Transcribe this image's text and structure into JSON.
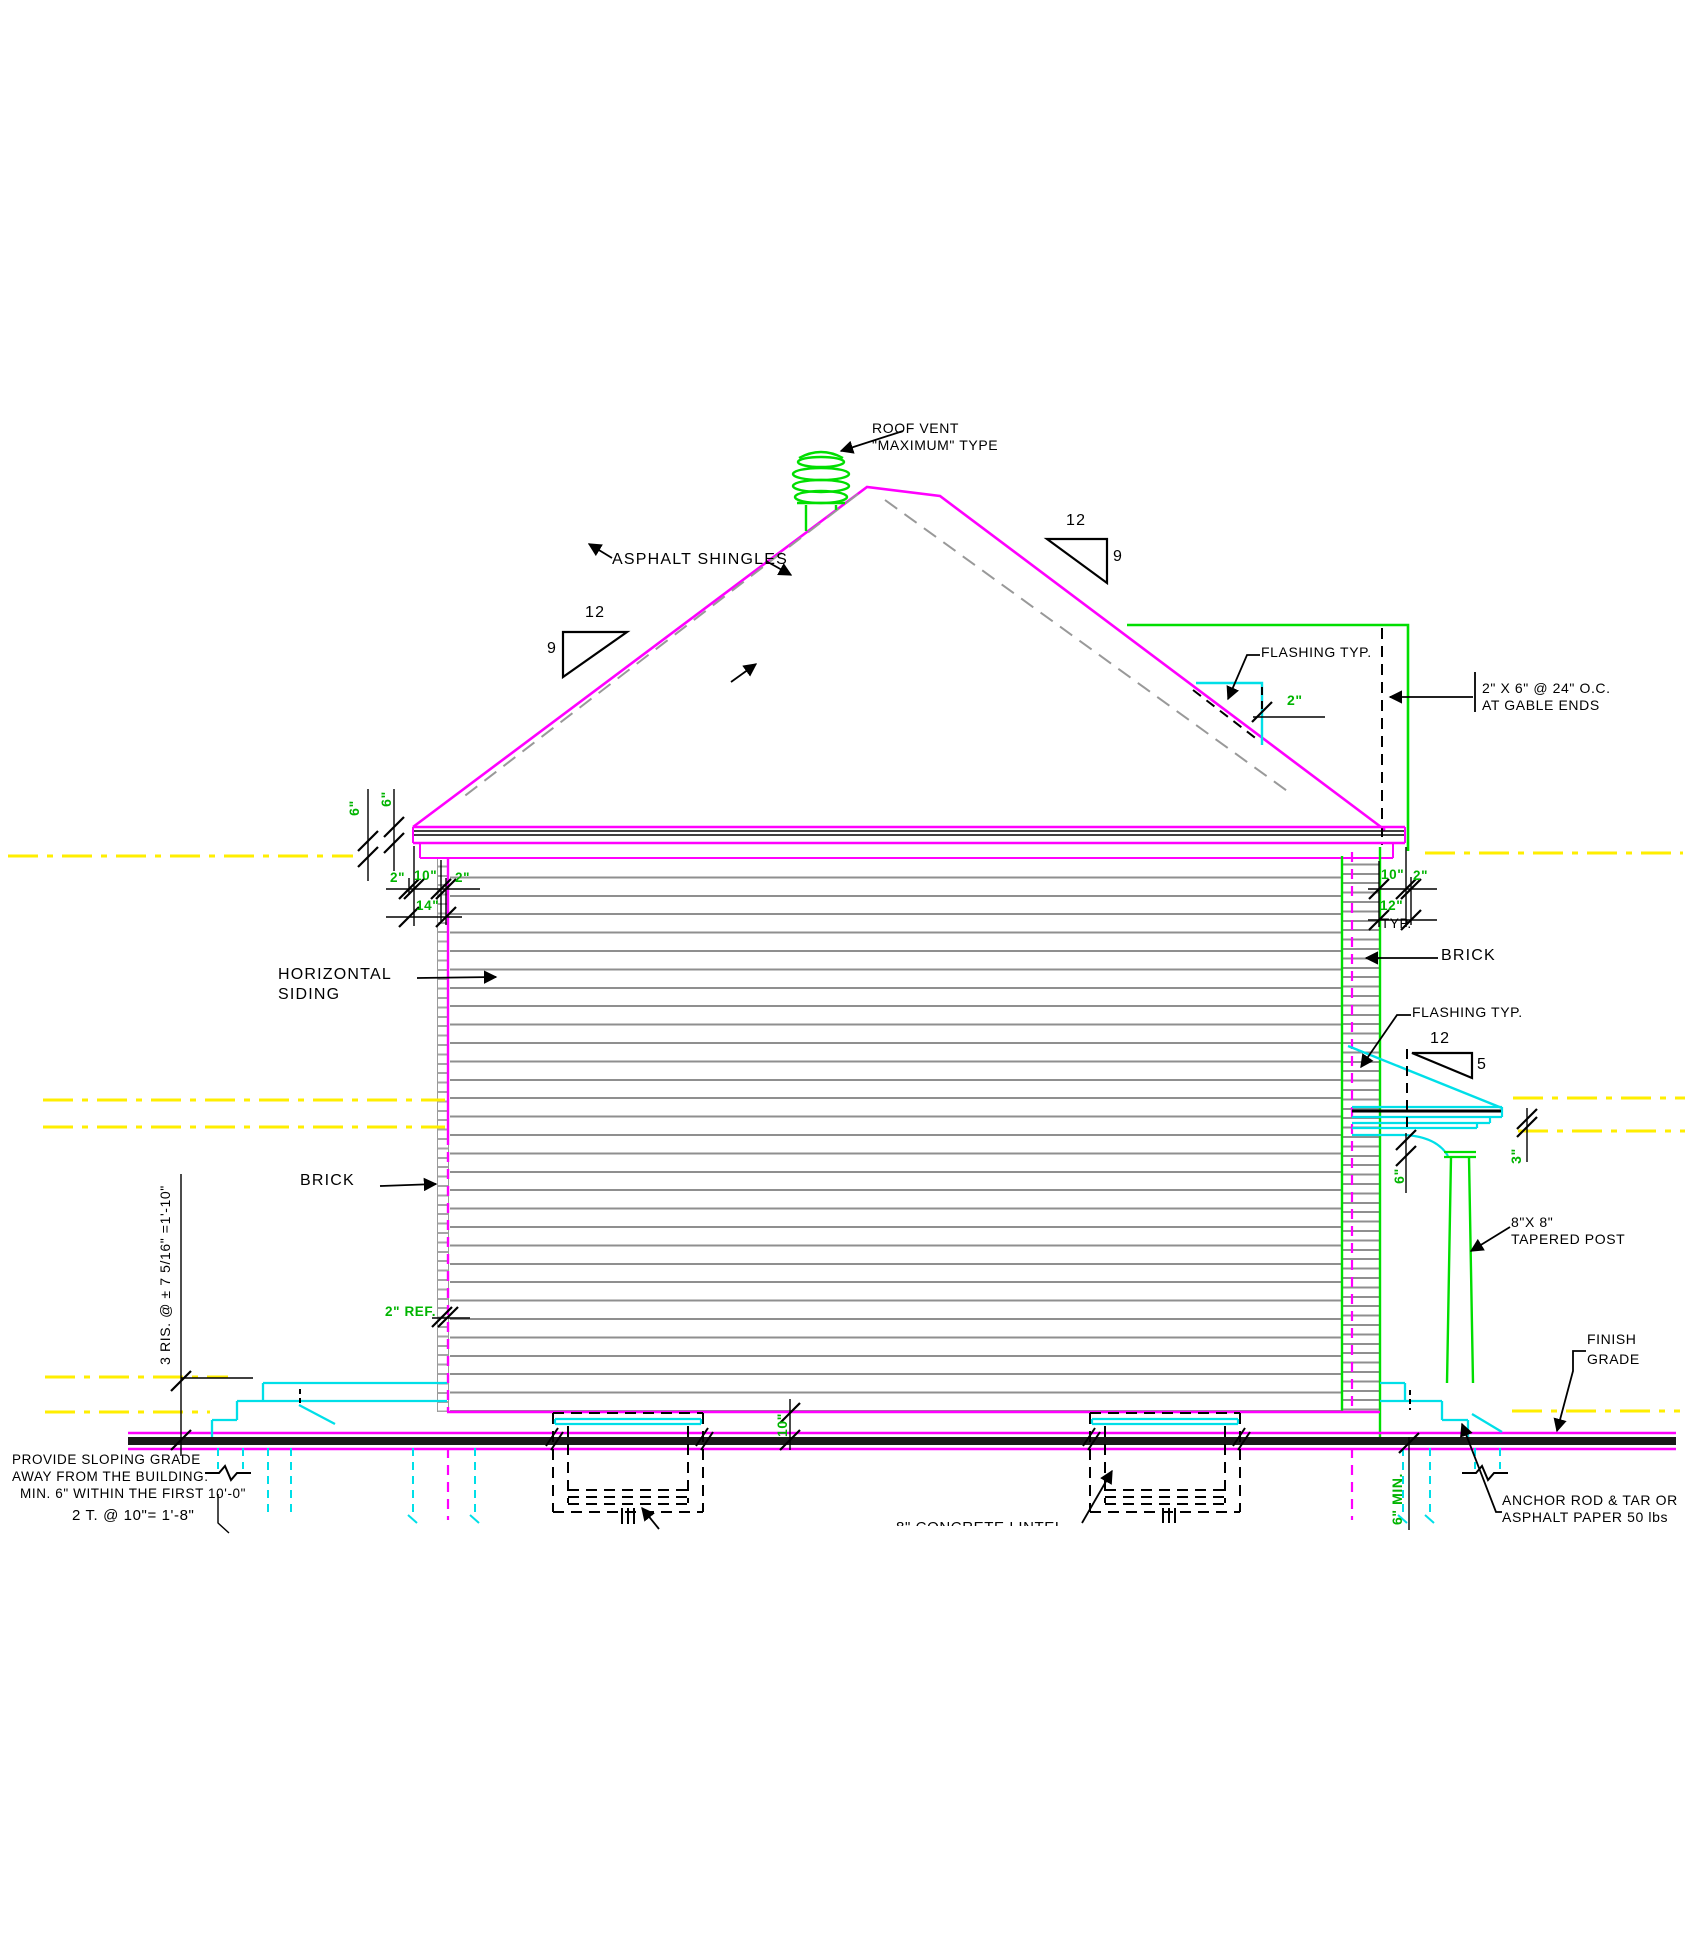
{
  "colors": {
    "magenta": "#FF00FF",
    "green_lines": "#00DE00",
    "green_text": "#00B400",
    "cyan": "#00DFE8",
    "yellow": "#FFEE00",
    "gray_siding": "#8F8F8F",
    "black": "#000000"
  },
  "labels": {
    "roof_vent_line1": "ROOF VENT",
    "roof_vent_line2": "\"MAXIMUM\" TYPE",
    "asphalt_shingles": "ASPHALT SHINGLES",
    "flashing_roof": "FLASHING TYP.",
    "gable_note_line1": "2\" X 6\" @ 24\" O.C.",
    "gable_note_line2": "AT GABLE ENDS",
    "horizontal_siding_line1": "HORIZONTAL",
    "horizontal_siding_line2": "SIDING",
    "brick_right": "BRICK",
    "brick_left": "BRICK",
    "flashing_porch": "FLASHING TYP.",
    "tapered_post_line1": "8\"X 8\"",
    "tapered_post_line2": "TAPERED POST",
    "finish_grade_line1": "FINISH",
    "finish_grade_line2": "GRADE",
    "anchor_line1": "ANCHOR ROD & TAR OR",
    "anchor_line2": "ASPHALT PAPER 50 lbs",
    "sloping_line1": "PROVIDE SLOPING GRADE",
    "sloping_line2": "AWAY FROM THE BUILDING.",
    "sloping_line3": "MIN. 6\" WITHIN THE FIRST 10'-0\"",
    "treads_note": "2 T. @ 10\"= 1'-8\"",
    "risers_note": "3 RIS. @ ± 7 5/16\" =1'-10\"",
    "six_min": "6\" MIN.",
    "lintel_note": "8\" CONCRETE LINTEL"
  },
  "pitch": {
    "main_run": "12",
    "main_rise": "9",
    "porch_run": "12",
    "porch_rise": "5"
  },
  "dims": {
    "d6a": "6\"",
    "d6b": "6\"",
    "d2a": "2\"",
    "d10a": "10\"",
    "d2b": "2\"",
    "d14": "14\"",
    "d10r": "10\"",
    "d2r": "2\"",
    "d12r": "12\"",
    "typ": "TYP.",
    "d2f": "2\"",
    "ref2": "2\" REF.",
    "d6p": "6\"",
    "d3p": "3\"",
    "d10f": "10\""
  }
}
